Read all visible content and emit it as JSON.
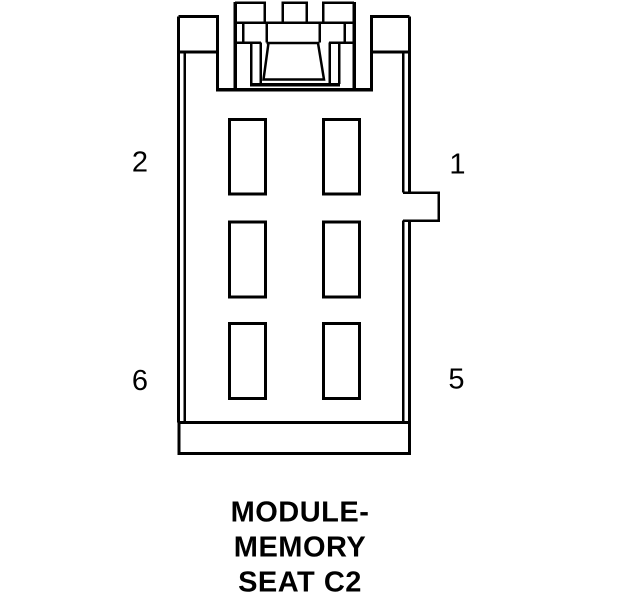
{
  "diagram": {
    "type": "connector-pinout",
    "connector_name": "MODULE- MEMORY SEAT C2",
    "caption_lines": [
      "MODULE-",
      "MEMORY",
      "SEAT C2"
    ],
    "pin_labels": {
      "top_left": "2",
      "top_right": "1",
      "bottom_left": "6",
      "bottom_right": "5"
    },
    "pin_slot_count": 6,
    "colors": {
      "line": "#000000",
      "background": "#ffffff",
      "text": "#000000"
    }
  }
}
